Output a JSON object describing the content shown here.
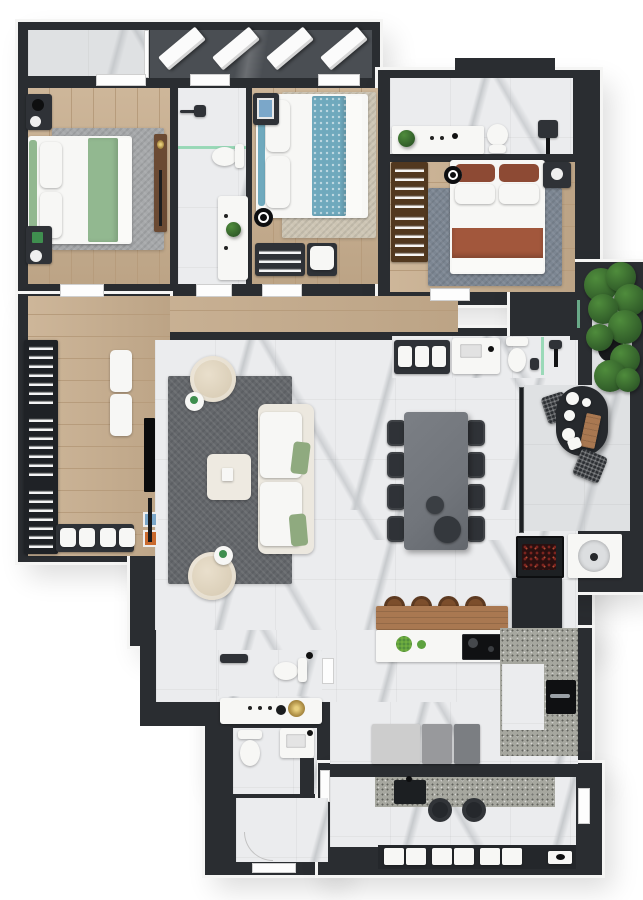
{
  "title": "3D apartment floor plan — top view render",
  "palette": {
    "wall": "#2a2d31",
    "wallLight": "#4a4e53",
    "marble": "#ebecee",
    "marbleVein": "#c7cacd",
    "marbleGray": "#dfe1e3",
    "wood": "#c8ae8e",
    "woodLine": "#b79c7c",
    "barWood": "#a97851",
    "consoleWood": "#6b4a33",
    "rugLiving": "#64676b",
    "rugGray": "#a6a8aa",
    "rugBeige": "#cdc5b4",
    "rugSlate": "#7c8692",
    "bedGreen": "#92b890",
    "bedBlue": "#6fa9bd",
    "bedRust": "#a2573c",
    "cream": "#ece8df",
    "beige": "#d9cdb6",
    "tableGray": "#71757b",
    "chairDark": "#2f3237",
    "stoolBrown": "#7c4e2c",
    "plantDark": "#2f5a28",
    "plantLight": "#4f8c3c",
    "gold": "#b3944a",
    "ember": "#7c241f",
    "granite": "#a6a79f",
    "glassGreen": "#7fd3a6",
    "applLight": "#cdcdcd",
    "applMid": "#98999c",
    "applDark": "#7b7e82",
    "orangeArt": "#c96a2e",
    "blueArt": "#7ba7c9"
  },
  "rooms": {
    "tech_balcony": "Technical balcony with AC condenser units",
    "bedroom1": "Bedroom 1 — green bedding, wood floor",
    "bathroom1": "Bathroom 1 — shower, toilet, vanity with plant",
    "bedroom2": "Bedroom 2 — blue bedding, clothes rack bench",
    "master_bathroom": "Master bathroom — vanity, toilet, shower",
    "master_bedroom": "Master bedroom — rust bedding, wardrobe",
    "hallway": "Hallway — closet, bench, poufs, leaning art",
    "living_room": "Living room — TV wall, sofa, armchairs",
    "guest_bathroom": "Guest bathroom — towel shelf, vanity, toilet, shower",
    "dining": "Dining — table for eight",
    "balcony": "Gourmet balcony — plant, oval table, grill, sink",
    "kitchen": "Kitchen — island with bar, cooktop, appliances, oven",
    "bathroom3": "Lavatory — vanity with gold flower, toilet",
    "bathroom4": "Service bathroom — toilet, sink, shower",
    "entry": "Entry hall",
    "laundry": "Laundry — granite counter, sink, basket cabinet"
  },
  "furniture_counts": {
    "ac_units": 4,
    "dining_chairs": 8,
    "bar_stools": 4,
    "laundry_baskets": 6,
    "closet_sections": 3,
    "hallway_poufs": 4,
    "towel_cubbies": 3,
    "balcony_chairs": 2,
    "living_armchairs": 2,
    "bedrooms": 3,
    "laundry_stools": 2
  }
}
